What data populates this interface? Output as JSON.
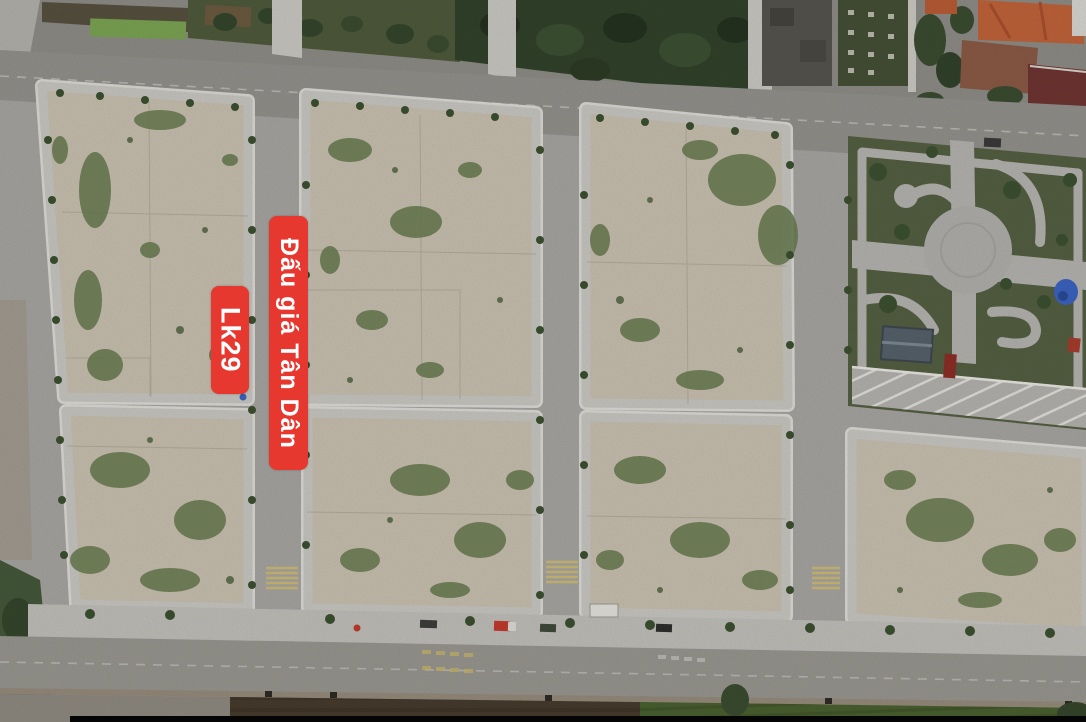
{
  "meta": {
    "description": "Aerial drone photograph of subdivided land auction plots (Tan Dan), with roads, a central park with circular plaza, houses at top and farmland at bottom",
    "width_px": 1086,
    "height_px": 722
  },
  "annotations": {
    "auction_banner": {
      "text": "Đấu giá Tân Dân",
      "bg_color": "#e73830",
      "text_color": "#ffffff"
    },
    "lot_label": {
      "text": "Lk29",
      "bg_color": "#e73830",
      "text_color": "#ffffff"
    }
  },
  "palette": {
    "road_concrete": "#a7a5a1",
    "road_asphalt": "#93918c",
    "sidewalk": "#c8c7c2",
    "curb_white": "#e3e2dd",
    "plot_sand": "#c8c0b0",
    "vegetation_green": "#66794d",
    "park_lawn": "#545f42",
    "park_path": "#b4b3af",
    "farmland_brown": "#463b2d",
    "garden_green": "#49602f",
    "tree_green": "#3c5030",
    "roof_orange": "#c0633a",
    "roof_maroon": "#6e3431",
    "tarp_blue": "#3b63c0"
  }
}
